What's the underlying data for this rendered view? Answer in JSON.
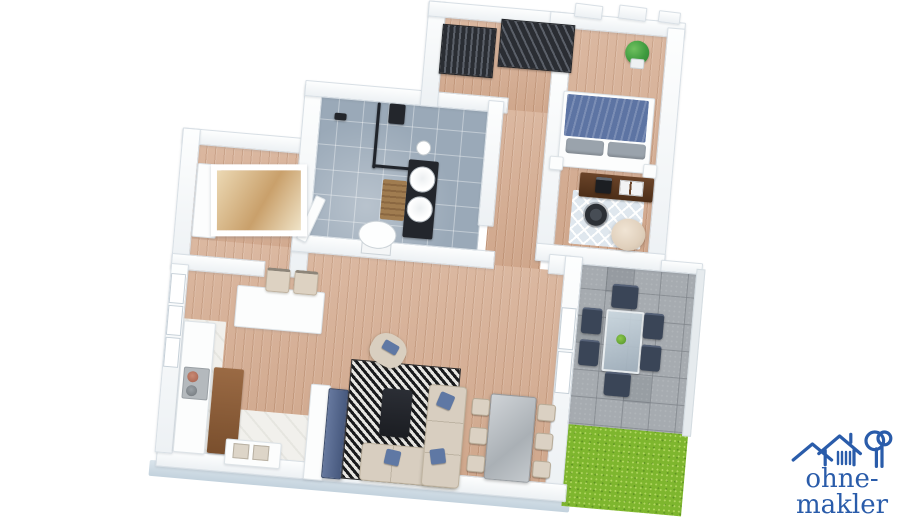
{
  "branding": {
    "logo_text": "ohne-makler",
    "logo_color": "#2a5caa",
    "logo_icons": [
      "house-outline-icon",
      "house-with-striped-window-icon",
      "tree-icon"
    ]
  },
  "scene": {
    "type": "3d-floor-plan-render",
    "view": "top-down isometric render, rotated slightly clockwise, white background",
    "rooms": [
      {
        "name": "entry-hall",
        "floor": "wood",
        "furniture": [
          "slatted-wardrobe",
          "slatted-wardrobe"
        ]
      },
      {
        "name": "bathroom",
        "floor": "blue-gray-tile",
        "furniture": [
          "walk-in-shower-glass",
          "shower-column",
          "double-vessel-sink-vanity",
          "toilet",
          "wooden-bath-mat",
          "toilet-paper-roll",
          "open-door"
        ]
      },
      {
        "name": "storage-room",
        "floor": "wood",
        "furniture": [
          "white-cabinet",
          "framed-picture"
        ]
      },
      {
        "name": "bedroom",
        "floor": "wood",
        "furniture": [
          "double-bed-blue-blanket",
          "nightstand",
          "nightstand",
          "desk-with-laptop",
          "office-chair",
          "diamond-rug",
          "beanbag",
          "potted-plant"
        ]
      },
      {
        "name": "living-kitchen",
        "floor": "wood-with-white-kitchen-strip",
        "furniture": [
          "kitchen-counter",
          "cooktop-with-pots",
          "wood-island",
          "double-sink",
          "breakfast-bar",
          "bar-stool",
          "bar-stool",
          "tv-partition-wall",
          "tv-panel",
          "black-white-rug",
          "coffee-table",
          "armchair",
          "corner-sofa-blue-pillows",
          "stone-dining-table",
          "six-dining-chairs"
        ]
      },
      {
        "name": "terrace",
        "floor": "stone-tile",
        "furniture": [
          "glass-outdoor-table",
          "six-outdoor-chairs"
        ]
      },
      {
        "name": "garden",
        "floor": "grass",
        "furniture": []
      }
    ],
    "palette": {
      "background": "#ffffff",
      "wall": "#f7f9fb",
      "wall_edge": "#d9e0e6",
      "plinth": "#cddbe4",
      "wood_floor": "#d7b096",
      "bathroom_tile": "#9aa9b8",
      "terrace_stone": "#a6abb0",
      "grass": "#7eb62e",
      "sofa_beige": "#d8cec0",
      "cushion_blue": "#5f78a4",
      "bed_blanket_blue": "#5d74a3",
      "desk_brown": "#5b3a22",
      "dark_fixture": "#23262c",
      "tv_blue_gray": "#566890",
      "outdoor_furniture": "#3a4557",
      "dining_table_gray": "#b6babf"
    }
  }
}
